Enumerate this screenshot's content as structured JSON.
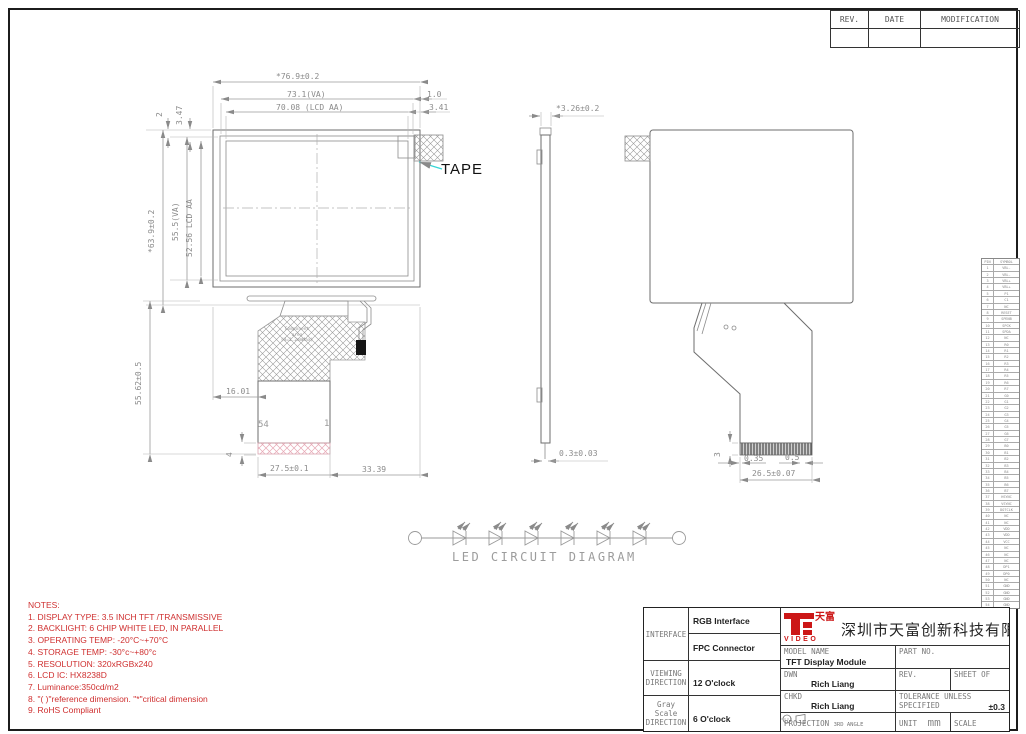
{
  "sheet": {
    "tape_label": "TAPE"
  },
  "rev_table": {
    "rev": "REV.",
    "date": "DATE",
    "modification": "MODIFICATION"
  },
  "front_view": {
    "dims": {
      "total_width": "*76.9±0.2",
      "va_width": "73.1(VA)",
      "aa_width": "70.08 (LCD AA)",
      "edge_right_1": "1.0",
      "edge_right_2": "3.41",
      "edge_top_1": "2",
      "edge_top_2": "3.47",
      "total_height": "*63.9±0.2",
      "va_height": "55.5(VA)",
      "aa_height": "52.56 LCD AA",
      "module_fpc_height": "55.62±0.5",
      "fpc_offset_left": "16.01",
      "fpc_width": "27.5±0.1",
      "fpc_offset_right": "33.39",
      "stiffener_height": "4"
    },
    "pin_first": "54",
    "pin_last": "1",
    "component_area": "Component\narea\n(H=1.2mmMax)"
  },
  "side_view": {
    "dims": {
      "thickness": "*3.26±0.2",
      "fpc_thickness": "0.3±0.03"
    }
  },
  "back_view": {
    "dims": {
      "connector_h": "3",
      "pitch_a": "0.35",
      "pitch_b": "0.5",
      "connector_w": "26.5±0.07"
    }
  },
  "led_diagram": {
    "title": "LED CIRCUIT DIAGRAM",
    "led_count": 6
  },
  "notes": {
    "title": "NOTES:",
    "items": [
      "1. DISPLAY TYPE: 3.5  INCH TFT /TRANSMISSIVE",
      "2. BACKLIGHT: 6 CHIP WHITE LED, IN PARALLEL",
      "3. OPERATING TEMP: -20°C~+70°C",
      "4. STORAGE TEMP: -30°c~+80°c",
      "5. RESOLUTION: 320xRGBx240",
      "6. LCD IC: HX8238D",
      "7.  Luminance:350cd/m2",
      "8. \"( )\"reference dimension. \"*\"critical dimension",
      "9. RoHS Compliant"
    ]
  },
  "title_block": {
    "interface_label": "INTERFACE",
    "interface_1": "RGB Interface",
    "interface_2": "FPC Connector",
    "viewing_label": "VIEWING\nDIRECTION",
    "viewing_value": "12 O'clock",
    "gray_label": "Gray Scale\nDIRECTION",
    "gray_value": "6 O'clock",
    "logo_zh": "天富",
    "logo_video": "VIDEO",
    "company": "深圳市天富创新科技有限公司",
    "model_label": "MODEL NAME",
    "model_value": "TFT Display Module",
    "part_label": "PART NO.",
    "dwn_label": "DWN",
    "dwn_value": "Rich Liang",
    "rev_label": "REV.",
    "sheet_label": "SHEET OF",
    "chkd_label": "CHKD",
    "chkd_value": "Rich Liang",
    "tol_label": "TOLERANCE UNLESS\nSPECIFIED",
    "tol_value": "±0.3",
    "proj_label": "PROJECTION",
    "proj_value": "3RD ANGLE",
    "unit_label": "UNIT",
    "unit_value": "mm",
    "scale_label": "SCALE",
    "scale_value": "1:1"
  },
  "pin_table": {
    "headers": [
      "PIN",
      "SYMBOL"
    ],
    "rows": [
      [
        "1",
        "VBL-"
      ],
      [
        "2",
        "VBL-"
      ],
      [
        "3",
        "VBL+"
      ],
      [
        "4",
        "VBL+"
      ],
      [
        "5",
        "P1"
      ],
      [
        "6",
        "C1"
      ],
      [
        "7",
        "NC"
      ],
      [
        "8",
        "RESET"
      ],
      [
        "9",
        "SPENB"
      ],
      [
        "10",
        "SPCK"
      ],
      [
        "11",
        "SPDA"
      ],
      [
        "12",
        "NC"
      ],
      [
        "13",
        "R0"
      ],
      [
        "14",
        "R1"
      ],
      [
        "15",
        "R2"
      ],
      [
        "16",
        "R3"
      ],
      [
        "17",
        "R4"
      ],
      [
        "18",
        "R5"
      ],
      [
        "19",
        "R6"
      ],
      [
        "20",
        "R7"
      ],
      [
        "21",
        "G0"
      ],
      [
        "22",
        "G1"
      ],
      [
        "23",
        "G2"
      ],
      [
        "24",
        "G3"
      ],
      [
        "25",
        "G4"
      ],
      [
        "26",
        "G5"
      ],
      [
        "27",
        "G6"
      ],
      [
        "28",
        "G7"
      ],
      [
        "29",
        "B0"
      ],
      [
        "30",
        "B1"
      ],
      [
        "31",
        "B2"
      ],
      [
        "32",
        "B3"
      ],
      [
        "33",
        "B4"
      ],
      [
        "34",
        "B5"
      ],
      [
        "35",
        "B6"
      ],
      [
        "36",
        "B7"
      ],
      [
        "37",
        "HSYNC"
      ],
      [
        "38",
        "VSYNC"
      ],
      [
        "39",
        "DOTCLK"
      ],
      [
        "40",
        "NC"
      ],
      [
        "41",
        "NC"
      ],
      [
        "42",
        "VDD"
      ],
      [
        "43",
        "VDD"
      ],
      [
        "44",
        "VCC"
      ],
      [
        "45",
        "NC"
      ],
      [
        "46",
        "NC"
      ],
      [
        "47",
        "NC"
      ],
      [
        "48",
        "DP1"
      ],
      [
        "49",
        "DP0"
      ],
      [
        "50",
        "NC"
      ],
      [
        "51",
        "GND"
      ],
      [
        "52",
        "GND"
      ],
      [
        "53",
        "GND"
      ],
      [
        "54",
        "GND"
      ]
    ]
  }
}
